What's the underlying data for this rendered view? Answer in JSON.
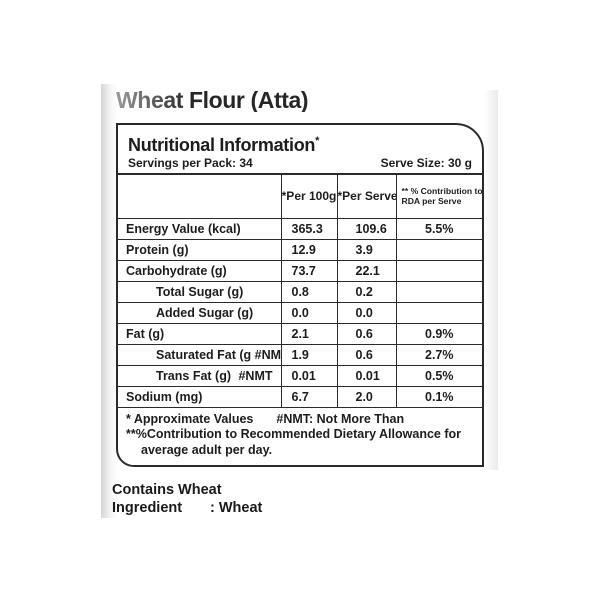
{
  "title": "Wheat Flour (Atta)",
  "panel": {
    "heading": "Nutritional Information",
    "heading_mark": "*",
    "servings_label": "Servings per Pack: 34",
    "serve_size_label": "Serve Size: 30 g"
  },
  "table": {
    "col2_header": "*Per 100g",
    "col3_header": "*Per Serve",
    "col4_header_line1": "** % Contribution to",
    "col4_header_line2": "RDA per Serve",
    "rows": [
      {
        "label": "Energy Value (kcal)",
        "indent": false,
        "per100g": "365.3",
        "perServe": "109.6",
        "rda": "5.5%"
      },
      {
        "label": "Protein (g)",
        "indent": false,
        "per100g": "12.9",
        "perServe": "3.9",
        "rda": ""
      },
      {
        "label": "Carbohydrate (g)",
        "indent": false,
        "per100g": "73.7",
        "perServe": "22.1",
        "rda": ""
      },
      {
        "label": "Total Sugar (g)",
        "indent": true,
        "per100g": "0.8",
        "perServe": "0.2",
        "rda": ""
      },
      {
        "label": "Added Sugar (g)",
        "indent": true,
        "per100g": "0.0",
        "perServe": "0.0",
        "rda": ""
      },
      {
        "label": "Fat (g)",
        "indent": false,
        "per100g": "2.1",
        "perServe": "0.6",
        "rda": "0.9%"
      },
      {
        "label": "Saturated Fat (g #NMT)",
        "indent": true,
        "per100g": "1.9",
        "perServe": "0.6",
        "rda": "2.7%"
      },
      {
        "label": "Trans Fat (g)",
        "label_suffix": "#NMT",
        "indent": true,
        "per100g": "0.01",
        "perServe": "0.01",
        "rda": "0.5%"
      },
      {
        "label": "Sodium (mg)",
        "indent": false,
        "per100g": "6.7",
        "perServe": "2.0",
        "rda": "0.1%"
      }
    ]
  },
  "footnotes": {
    "approx": "* Approximate Values",
    "nmt": "#NMT: Not More Than",
    "rda_line1": "**%Contribution to Recommended Dietary Allowance for",
    "rda_line2": "average adult per day."
  },
  "footer": {
    "contains": "Contains Wheat",
    "ingredient_label": "Ingredient",
    "ingredient_value": ": Wheat"
  },
  "colors": {
    "text": "#1d1d1d",
    "border": "#2a2a2a",
    "background": "#ffffff"
  }
}
